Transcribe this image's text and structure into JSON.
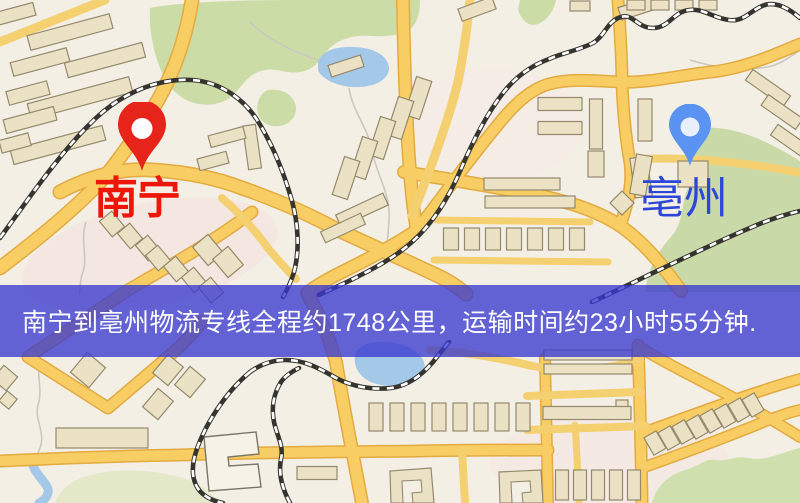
{
  "map": {
    "origin_label": "南宁",
    "destination_label": "亳州",
    "banner_text": "南宁到亳州物流专线全程约1748公里，运输时间约23小时55分钟.",
    "route": {
      "origin": "南宁",
      "destination": "亳州",
      "distance_text": "约1748公里",
      "duration_text": "约23小时55分钟"
    },
    "icons": {
      "origin_pin": "red-map-pin-icon",
      "destination_pin": "blue-map-pin-icon"
    },
    "colors": {
      "origin_label": "#ee1509",
      "origin_pin": "#e6241a",
      "destination_label": "#2b46d9",
      "destination_pin": "#5b93f2",
      "banner_bg": "#3a3ad0",
      "banner_text": "#ffffff",
      "road": "#f7cd64",
      "water": "#a3c8e8",
      "park": "#ccdca6",
      "map_background": "#f4efe5"
    }
  }
}
